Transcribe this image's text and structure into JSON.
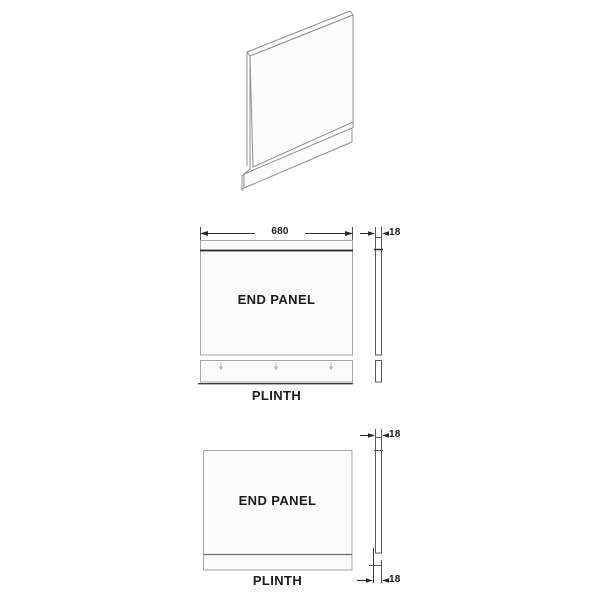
{
  "image": {
    "type": "bath-end-panel-technical-drawing",
    "background": "#ffffff"
  },
  "colors": {
    "line_light": "#a6a6a6",
    "line_mid": "#5a5a5a",
    "line_dark": "#262626",
    "panel_fill": "#fbfbfb",
    "text": "#1c1c1c",
    "mark_light": "#b8b8b8"
  },
  "views": {
    "perspective": {
      "description": "3d-end-panel-with-plinth"
    },
    "front_top": {
      "panel_label": "END PANEL",
      "plinth_label": "PLINTH",
      "width_mm": "680",
      "thickness_mm": "18"
    },
    "front_bottom": {
      "panel_label": "END PANEL",
      "plinth_label": "PLINTH",
      "thickness_top_mm": "18",
      "thickness_bottom_mm": "18"
    }
  }
}
